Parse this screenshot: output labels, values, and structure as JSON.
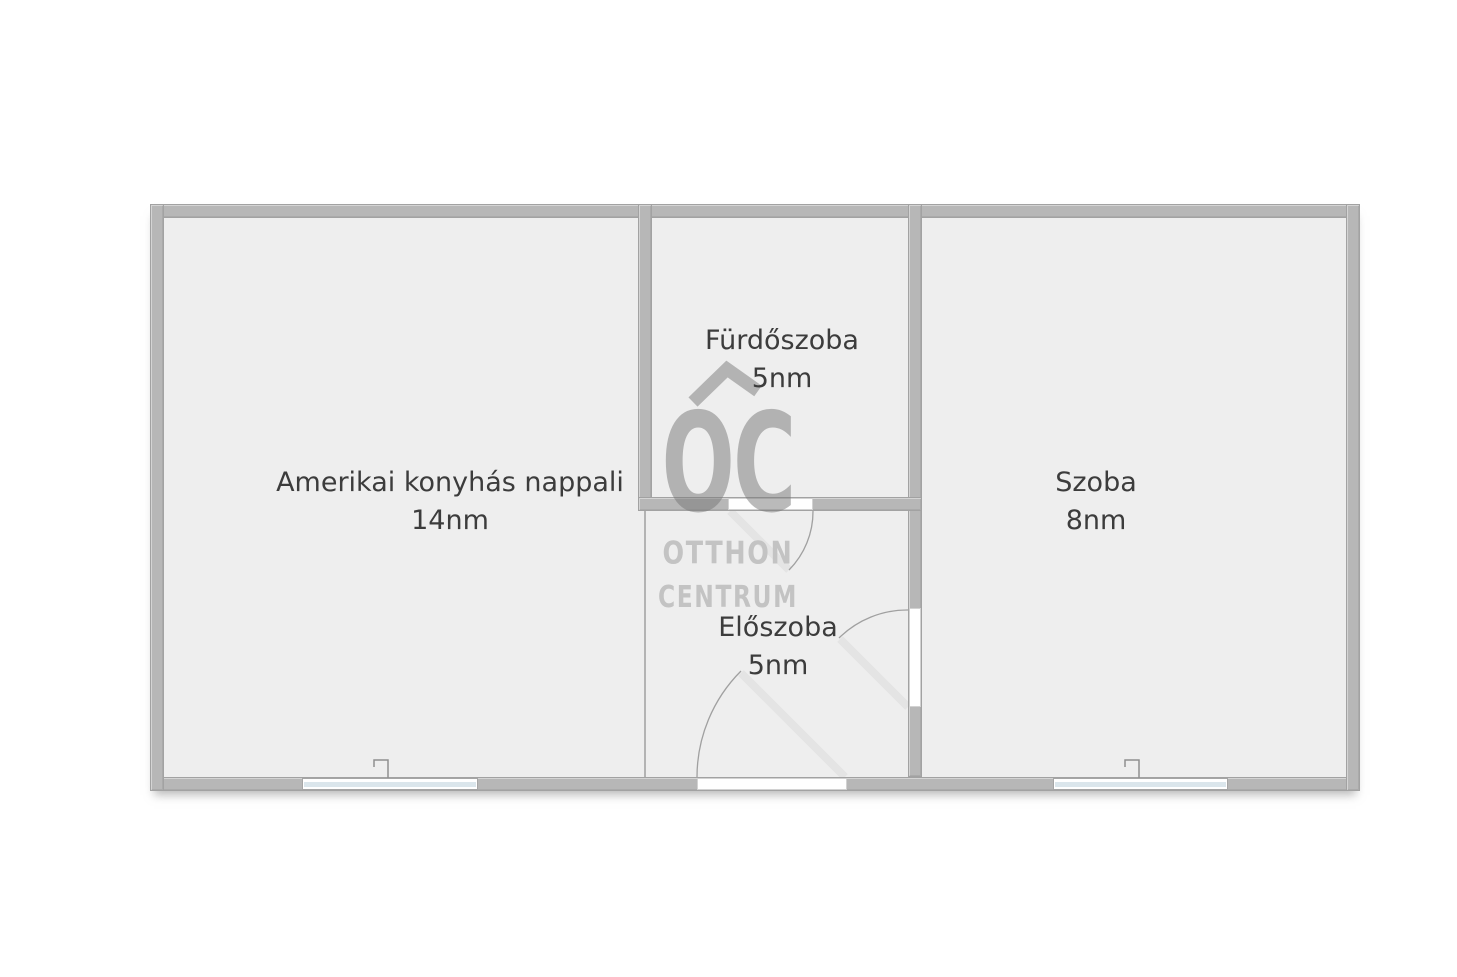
{
  "plan": {
    "rooms": [
      {
        "name": "Amerikai konyhás nappali",
        "area": "14nm"
      },
      {
        "name": "Fürdőszoba",
        "area": "5nm"
      },
      {
        "name": "Szoba",
        "area": "8nm"
      },
      {
        "name": "Előszoba",
        "area": "5nm"
      }
    ],
    "watermark": {
      "monogram": "OC",
      "name_line1": "OTTHON",
      "name_line2": "CENTRUM"
    },
    "colors": {
      "wall": "#b7b7b7",
      "wall_edge": "#a2a2a2",
      "floor": "#eeeeee",
      "label_text": "#3c3c3c",
      "watermark_gray": "#b3b3b3",
      "watermark_text": "#c3c3c3",
      "window_glass": "#dbe6ec",
      "door_arc": "#a0a0a0",
      "door_leaf": "#e3e3e3"
    }
  }
}
